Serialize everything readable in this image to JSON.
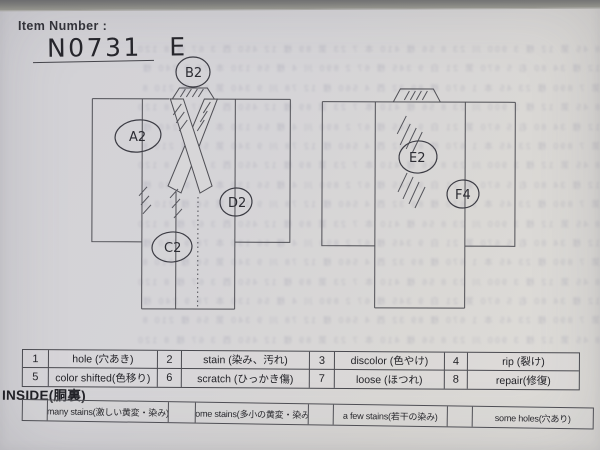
{
  "header": {
    "item_label": "Item Number :",
    "item_number": "N0731 E"
  },
  "markers": [
    {
      "label": "A2"
    },
    {
      "label": "B2"
    },
    {
      "label": "C2"
    },
    {
      "label": "D2"
    },
    {
      "label": "E2"
    },
    {
      "label": "F4"
    }
  ],
  "legend": {
    "items": [
      {
        "num": "1",
        "label": "hole (穴あき)"
      },
      {
        "num": "2",
        "label": "stain (染み、汚れ)"
      },
      {
        "num": "3",
        "label": "discolor (色やけ)"
      },
      {
        "num": "4",
        "label": "rip (裂け)"
      },
      {
        "num": "5",
        "label": "color shifted(色移り)"
      },
      {
        "num": "6",
        "label": "scratch (ひっかき傷)"
      },
      {
        "num": "7",
        "label": "loose (ほつれ)"
      },
      {
        "num": "8",
        "label": "repair(修復)"
      }
    ]
  },
  "inside": {
    "title": "INSIDE(胴裏)",
    "options": [
      {
        "label": "many stains(激しい黄変・染み)"
      },
      {
        "label": "some stains(多小の黄変・染み)"
      },
      {
        "label": "a few stains(若干の染み)"
      },
      {
        "label": "some holes(穴あり)"
      }
    ]
  },
  "colors": {
    "paper": "#d6d5d7",
    "ink": "#4f4f55",
    "text": "#26262c"
  },
  "noise": {
    "rows": [
      "8 45 第 12 様 3 900 川 23 8 56 様 410 本 7 23 第 89 様 12 450 西 3 67 様 8 120",
      "12 様 34 80 右 5 670 第 21 白 9 345 様 67 2 890 川 4 様 56 130 本 78 9 240 様",
      "第 7 890 様 23 45 本 1 670 様 89 32 西 4 560 様 12 78 川 9 340 第 56 様 210 8"
    ]
  }
}
